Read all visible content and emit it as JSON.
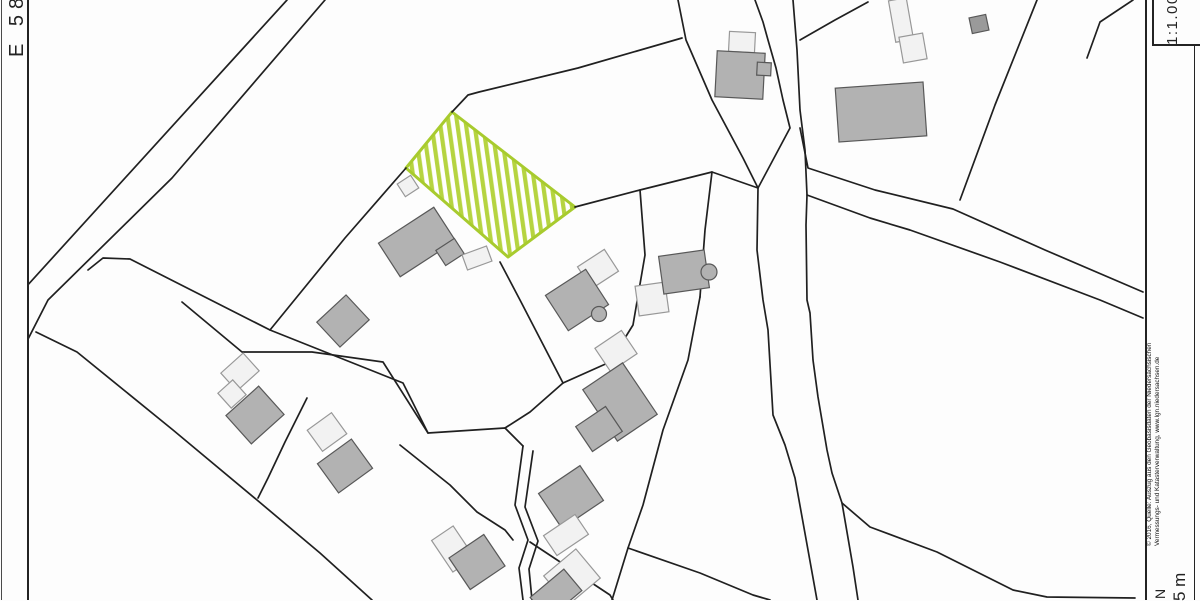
{
  "frame": {
    "easting_label": "E 58",
    "scale_label": "1:1.000",
    "attribution_line1": "© 2016, Quelle: Auszug aus den Geobasisdaten der Niedersächsischen",
    "attribution_line2": "Vermessungs- und Katasterverwaltung, www.lgn.niedersachsen.de",
    "north_label": "N",
    "scalebar_label": "5 m"
  },
  "colors": {
    "line": "#202020",
    "building_fill": "#b2b2b2",
    "building_stroke": "#585858",
    "light_fill": "#f2f2f2",
    "light_stroke": "#989898",
    "shed_fill": "#9a9a9a",
    "highlight_stroke": "#a8cb2e",
    "highlight_stripe": "#b6d441",
    "paper": "#fdfdfd"
  },
  "map": {
    "highlight_parcel": {
      "name": "subject-plot",
      "points": [
        [
          452,
          112
        ],
        [
          406,
          168
        ],
        [
          508,
          257
        ],
        [
          575,
          207
        ]
      ]
    },
    "lines": [
      {
        "pts": [
          [
            287,
            0
          ],
          [
            25,
            288
          ]
        ]
      },
      {
        "pts": [
          [
            325,
            0
          ],
          [
            172,
            178
          ],
          [
            48,
            300
          ],
          [
            25,
            345
          ]
        ]
      },
      {
        "pts": [
          [
            678,
            0
          ],
          [
            686,
            40
          ],
          [
            712,
            100
          ],
          [
            743,
            158
          ],
          [
            758,
            188
          ],
          [
            757,
            250
          ],
          [
            763,
            300
          ],
          [
            768,
            330
          ],
          [
            773,
            415
          ],
          [
            785,
            445
          ],
          [
            795,
            478
          ],
          [
            808,
            550
          ],
          [
            817,
            600
          ]
        ]
      },
      {
        "pts": [
          [
            755,
            0
          ],
          [
            763,
            22
          ],
          [
            768,
            40
          ],
          [
            776,
            68
          ],
          [
            783,
            100
          ],
          [
            790,
            128
          ],
          [
            758,
            188
          ]
        ]
      },
      {
        "pts": [
          [
            793,
            0
          ],
          [
            797,
            50
          ],
          [
            800,
            110
          ],
          [
            805,
            150
          ],
          [
            807,
            195
          ],
          [
            806,
            225
          ],
          [
            807,
            300
          ],
          [
            810,
            313
          ],
          [
            813,
            360
          ],
          [
            818,
            397
          ],
          [
            827,
            450
          ],
          [
            832,
            473
          ],
          [
            842,
            503
          ],
          [
            853,
            567
          ],
          [
            858,
            600
          ]
        ]
      },
      {
        "pts": [
          [
            800,
            128
          ],
          [
            808,
            168
          ],
          [
            875,
            190
          ],
          [
            953,
            209
          ],
          [
            1045,
            250
          ],
          [
            1143,
            292
          ]
        ]
      },
      {
        "pts": [
          [
            807,
            195
          ],
          [
            870,
            218
          ],
          [
            910,
            230
          ],
          [
            1000,
            262
          ],
          [
            1100,
            300
          ],
          [
            1143,
            318
          ]
        ]
      },
      {
        "pts": [
          [
            800,
            40
          ],
          [
            835,
            20
          ],
          [
            868,
            2
          ]
        ]
      },
      {
        "pts": [
          [
            1037,
            0
          ],
          [
            995,
            105
          ],
          [
            960,
            200
          ]
        ]
      },
      {
        "pts": [
          [
            1133,
            0
          ],
          [
            1100,
            22
          ],
          [
            1087,
            58
          ]
        ]
      },
      {
        "pts": [
          [
            452,
            112
          ],
          [
            468,
            95
          ],
          [
            479,
            92
          ],
          [
            578,
            68
          ],
          [
            682,
            38
          ]
        ]
      },
      {
        "pts": [
          [
            575,
            207
          ],
          [
            640,
            190
          ],
          [
            712,
            172
          ],
          [
            758,
            188
          ]
        ]
      },
      {
        "pts": [
          [
            406,
            168
          ],
          [
            345,
            238
          ],
          [
            270,
            330
          ]
        ]
      },
      {
        "pts": [
          [
            88,
            270
          ],
          [
            103,
            258
          ],
          [
            130,
            259
          ],
          [
            270,
            330
          ],
          [
            403,
            383
          ],
          [
            428,
            433
          ],
          [
            505,
            428
          ],
          [
            523,
            446
          ]
        ]
      },
      {
        "pts": [
          [
            523,
            446
          ],
          [
            515,
            505
          ],
          [
            528,
            540
          ],
          [
            519,
            568
          ],
          [
            523,
            600
          ]
        ]
      },
      {
        "pts": [
          [
            533,
            451
          ],
          [
            525,
            507
          ],
          [
            538,
            541
          ],
          [
            529,
            569
          ],
          [
            532,
            600
          ]
        ]
      },
      {
        "pts": [
          [
            36,
            332
          ],
          [
            77,
            352
          ],
          [
            173,
            430
          ],
          [
            257,
            500
          ],
          [
            320,
            553
          ],
          [
            372,
            600
          ]
        ]
      },
      {
        "pts": [
          [
            182,
            302
          ],
          [
            242,
            352
          ],
          [
            312,
            352
          ],
          [
            383,
            362
          ],
          [
            428,
            433
          ]
        ]
      },
      {
        "pts": [
          [
            307,
            398
          ],
          [
            285,
            442
          ],
          [
            268,
            478
          ],
          [
            258,
            498
          ]
        ]
      },
      {
        "pts": [
          [
            640,
            190
          ],
          [
            645,
            255
          ],
          [
            633,
            325
          ],
          [
            610,
            362
          ],
          [
            563,
            383
          ]
        ]
      },
      {
        "pts": [
          [
            500,
            262
          ],
          [
            520,
            300
          ],
          [
            563,
            383
          ]
        ]
      },
      {
        "pts": [
          [
            563,
            383
          ],
          [
            530,
            412
          ],
          [
            505,
            428
          ]
        ]
      },
      {
        "pts": [
          [
            400,
            445
          ],
          [
            450,
            485
          ],
          [
            477,
            512
          ],
          [
            505,
            530
          ],
          [
            513,
            540
          ]
        ]
      },
      {
        "pts": [
          [
            712,
            172
          ],
          [
            705,
            230
          ],
          [
            700,
            297
          ]
        ]
      },
      {
        "pts": [
          [
            700,
            297
          ],
          [
            688,
            360
          ],
          [
            663,
            430
          ],
          [
            643,
            505
          ],
          [
            628,
            548
          ],
          [
            612,
            600
          ]
        ]
      },
      {
        "pts": [
          [
            530,
            542
          ],
          [
            610,
            595
          ],
          [
            613,
            600
          ]
        ]
      },
      {
        "pts": [
          [
            628,
            548
          ],
          [
            700,
            573
          ],
          [
            753,
            595
          ],
          [
            770,
            600
          ]
        ]
      },
      {
        "pts": [
          [
            842,
            503
          ],
          [
            870,
            527
          ],
          [
            937,
            552
          ],
          [
            1013,
            590
          ],
          [
            1047,
            597
          ],
          [
            1135,
            598
          ]
        ]
      }
    ],
    "buildings": [
      {
        "cx": 240,
        "cy": 372,
        "w": 30,
        "h": 24,
        "r": -42,
        "tone": "light"
      },
      {
        "cx": 232,
        "cy": 394,
        "w": 20,
        "h": 20,
        "r": -42,
        "tone": "light"
      },
      {
        "cx": 255,
        "cy": 415,
        "w": 44,
        "h": 38,
        "r": -42,
        "tone": "dark"
      },
      {
        "cx": 327,
        "cy": 432,
        "w": 30,
        "h": 26,
        "r": -36,
        "tone": "light"
      },
      {
        "cx": 345,
        "cy": 466,
        "w": 42,
        "h": 36,
        "r": -36,
        "tone": "dark"
      },
      {
        "cx": 343,
        "cy": 321,
        "w": 40,
        "h": 34,
        "r": -43,
        "tone": "dark"
      },
      {
        "cx": 408,
        "cy": 186,
        "w": 16,
        "h": 15,
        "r": -33,
        "tone": "light"
      },
      {
        "cx": 417,
        "cy": 242,
        "w": 66,
        "h": 40,
        "r": -33,
        "tone": "dark"
      },
      {
        "cx": 450,
        "cy": 252,
        "w": 22,
        "h": 18,
        "r": -33,
        "tone": "dark"
      },
      {
        "cx": 477,
        "cy": 258,
        "w": 26,
        "h": 16,
        "r": -20,
        "tone": "light"
      },
      {
        "cx": 598,
        "cy": 269,
        "w": 32,
        "h": 26,
        "r": -33,
        "tone": "light"
      },
      {
        "cx": 577,
        "cy": 300,
        "w": 48,
        "h": 42,
        "r": -33,
        "tone": "dark"
      },
      {
        "cx": 652,
        "cy": 299,
        "w": 30,
        "h": 30,
        "r": -8,
        "tone": "light"
      },
      {
        "cx": 684,
        "cy": 272,
        "w": 46,
        "h": 38,
        "r": -8,
        "tone": "dark"
      },
      {
        "cx": 742,
        "cy": 42,
        "w": 26,
        "h": 20,
        "r": 3,
        "tone": "light"
      },
      {
        "cx": 740,
        "cy": 75,
        "w": 48,
        "h": 46,
        "r": 3,
        "tone": "dark"
      },
      {
        "cx": 764,
        "cy": 69,
        "w": 14,
        "h": 13,
        "r": 3,
        "tone": "dark"
      },
      {
        "cx": 901,
        "cy": 20,
        "w": 18,
        "h": 42,
        "r": -10,
        "tone": "light"
      },
      {
        "cx": 913,
        "cy": 48,
        "w": 24,
        "h": 26,
        "r": -10,
        "tone": "light"
      },
      {
        "cx": 881,
        "cy": 112,
        "w": 88,
        "h": 54,
        "r": -4,
        "tone": "dark"
      },
      {
        "cx": 979,
        "cy": 24,
        "w": 17,
        "h": 16,
        "r": -12,
        "tone": "shed"
      },
      {
        "cx": 616,
        "cy": 351,
        "w": 32,
        "h": 28,
        "r": -34,
        "tone": "light"
      },
      {
        "cx": 620,
        "cy": 402,
        "w": 48,
        "h": 62,
        "r": -34,
        "tone": "dark"
      },
      {
        "cx": 599,
        "cy": 429,
        "w": 36,
        "h": 30,
        "r": -34,
        "tone": "dark"
      },
      {
        "cx": 571,
        "cy": 497,
        "w": 50,
        "h": 42,
        "r": -34,
        "tone": "dark"
      },
      {
        "cx": 566,
        "cy": 535,
        "w": 38,
        "h": 24,
        "r": -34,
        "tone": "light"
      },
      {
        "cx": 453,
        "cy": 549,
        "w": 26,
        "h": 38,
        "r": -34,
        "tone": "light"
      },
      {
        "cx": 477,
        "cy": 562,
        "w": 42,
        "h": 38,
        "r": -34,
        "tone": "dark"
      },
      {
        "cx": 572,
        "cy": 577,
        "w": 42,
        "h": 38,
        "r": -40,
        "tone": "light"
      },
      {
        "cx": 556,
        "cy": 594,
        "w": 44,
        "h": 28,
        "r": -40,
        "tone": "dark"
      }
    ],
    "bumps": [
      {
        "cx": 599,
        "cy": 314,
        "r": 7.5
      },
      {
        "cx": 709,
        "cy": 272,
        "r": 8
      }
    ]
  }
}
